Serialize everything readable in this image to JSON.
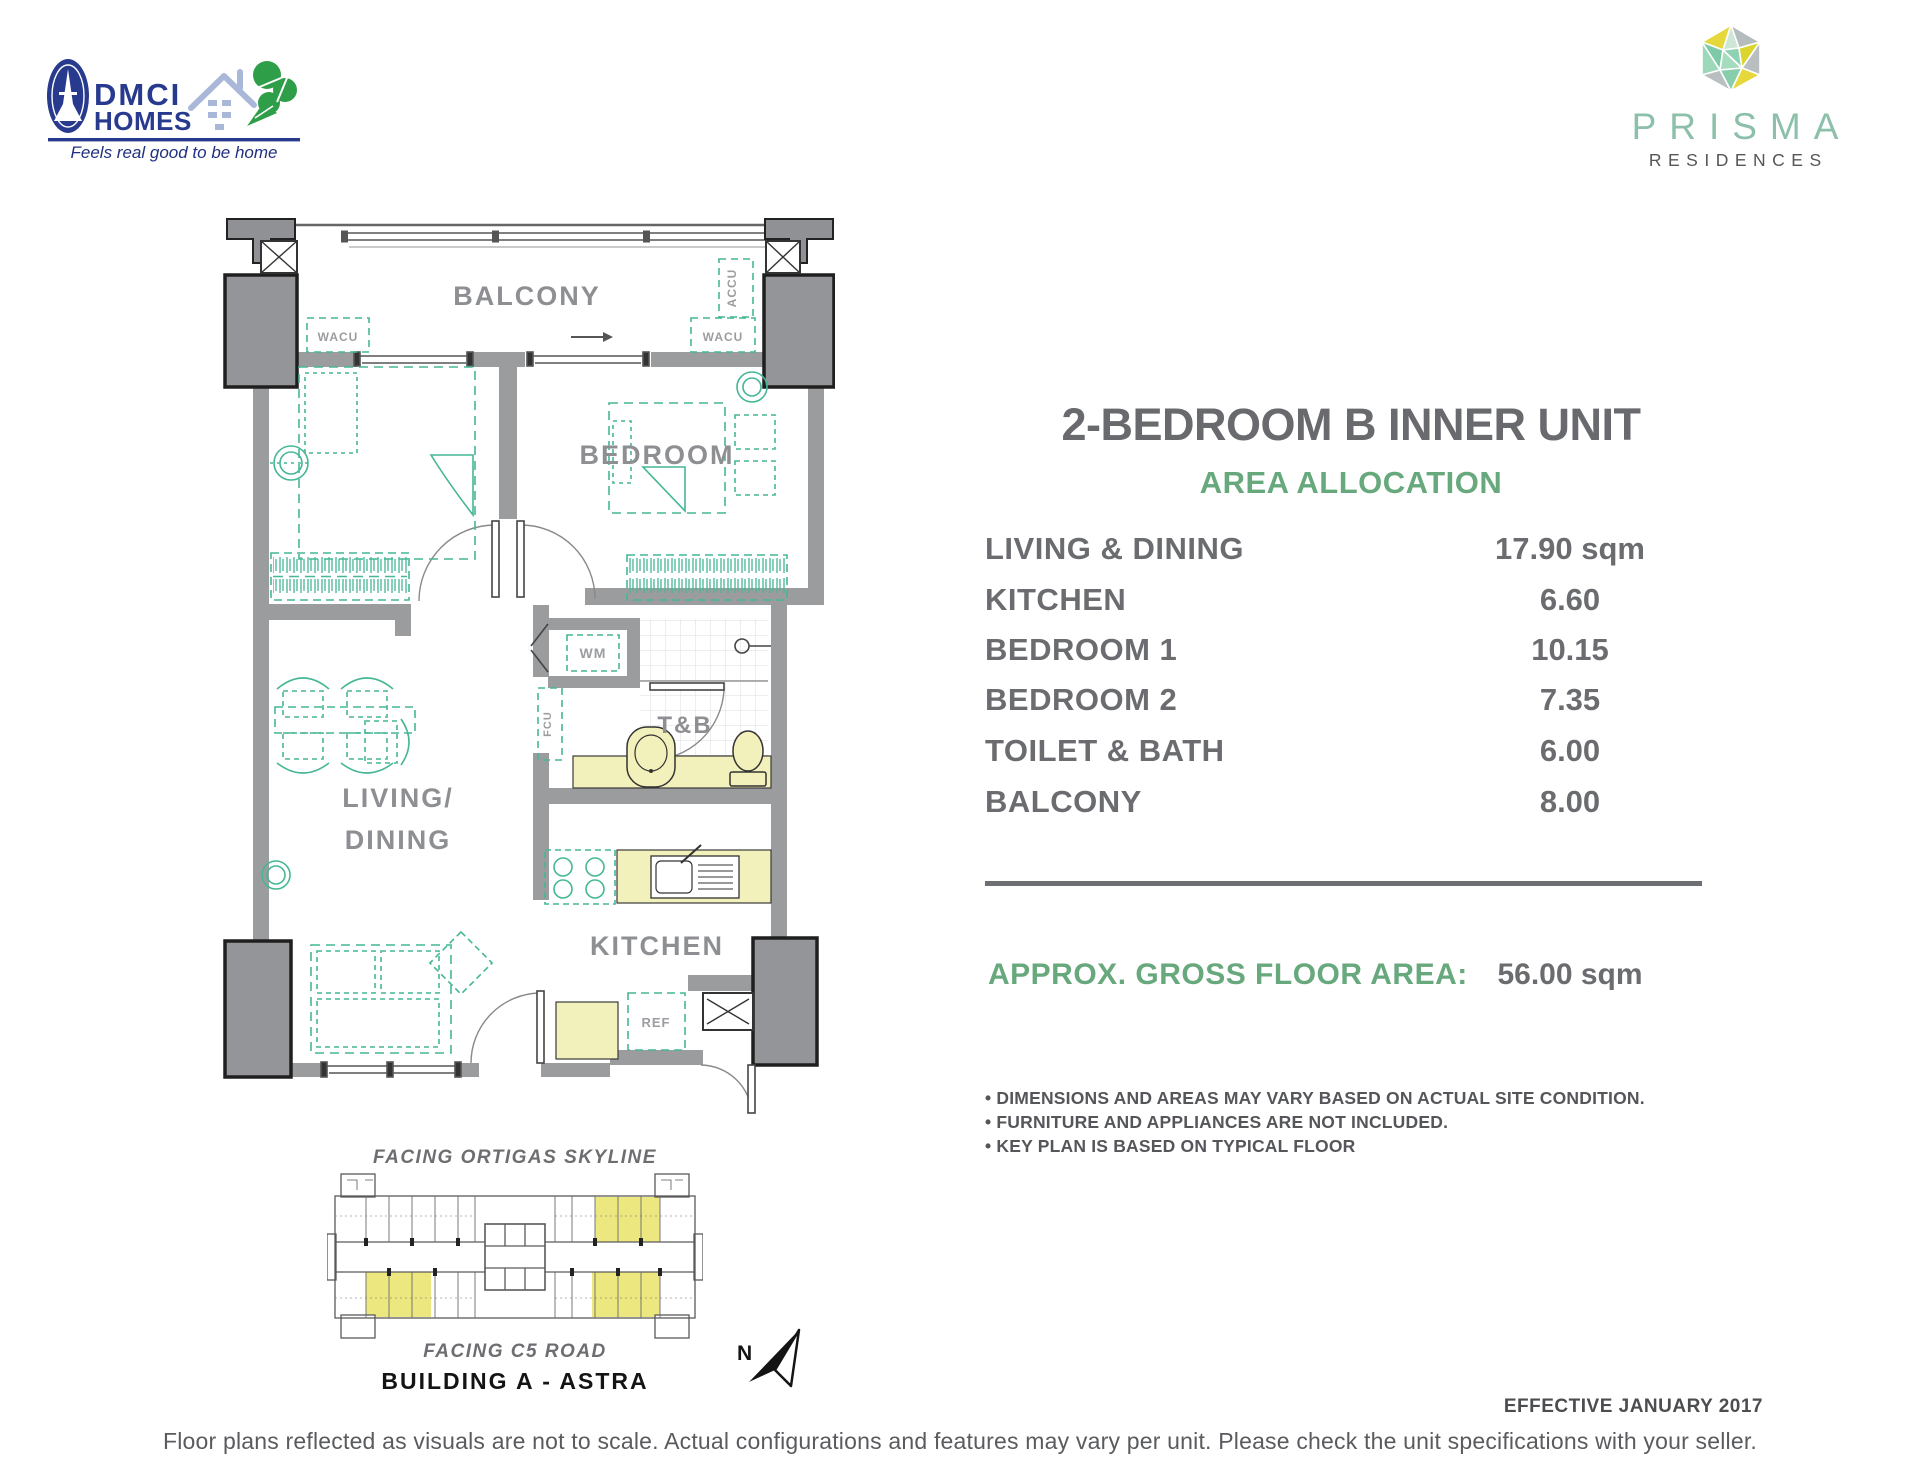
{
  "branding": {
    "dmci": {
      "line1": "DMCI",
      "line2": "HOMES",
      "tagline": "Feels real good to be home"
    },
    "prisma": {
      "name": "PRISMA",
      "subtitle": "RESIDENCES"
    }
  },
  "panel": {
    "title": "2-BEDROOM B INNER UNIT",
    "section": "AREA ALLOCATION",
    "rows": [
      {
        "label": "LIVING & DINING",
        "value": "17.90 sqm"
      },
      {
        "label": "KITCHEN",
        "value": "6.60"
      },
      {
        "label": "BEDROOM 1",
        "value": "10.15"
      },
      {
        "label": "BEDROOM 2",
        "value": "7.35"
      },
      {
        "label": "TOILET & BATH",
        "value": "6.00"
      },
      {
        "label": "BALCONY",
        "value": "8.00"
      }
    ],
    "gross_label": "APPROX. GROSS FLOOR AREA:",
    "gross_value": "56.00 sqm",
    "bullet": "•",
    "notes": [
      "DIMENSIONS AND AREAS MAY VARY BASED ON ACTUAL SITE CONDITION.",
      "FURNITURE AND APPLIANCES ARE NOT INCLUDED.",
      "KEY PLAN IS BASED ON TYPICAL FLOOR"
    ]
  },
  "floorplan": {
    "labels": {
      "balcony": "BALCONY",
      "bedroom": "BEDROOM",
      "living1": "LIVING/",
      "living2": "DINING",
      "tb": "T&B",
      "kitchen": "KITCHEN",
      "wacu": "WACU",
      "accu": "ACCU",
      "wm": "WM",
      "fcu": "FCU",
      "ref": "REF"
    }
  },
  "keyplan": {
    "facing_top": "FACING ORTIGAS SKYLINE",
    "facing_bottom": "FACING C5 ROAD",
    "building": "BUILDING A - ASTRA",
    "north": "N"
  },
  "footer": {
    "effective": "EFFECTIVE JANUARY 2017",
    "disclaimer": "Floor plans reflected as visuals are not to scale. Actual configurations and features may vary per unit. Please check the unit specifications with your seller."
  },
  "colors": {
    "furniture_green": "#45b796",
    "panel_green": "#68a87d",
    "text_gray": "#6d6e71",
    "wall_gray": "#9a9c9e",
    "fixture_yellow": "#f2f0bb",
    "dmci_navy": "#283a8e",
    "clover_green": "#2f9e48",
    "prisma_teal": "#8cc0aa",
    "keyplan_highlight": "#ece87f"
  }
}
